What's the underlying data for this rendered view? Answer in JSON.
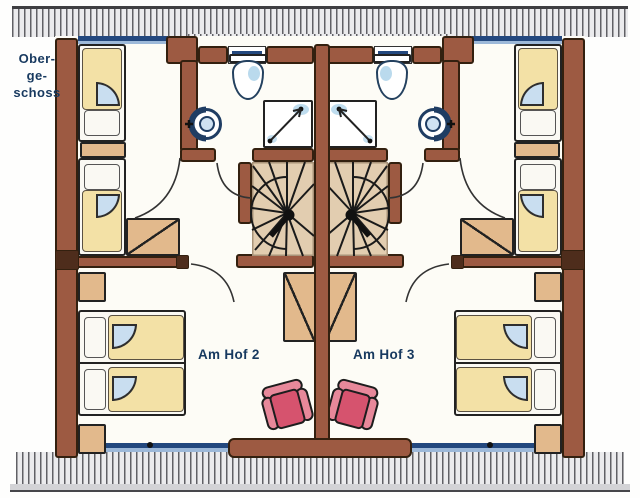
{
  "labels": {
    "floor_line1": "Ober-",
    "floor_line2": "ge-",
    "floor_line3": "schoss"
  },
  "units": [
    {
      "label": "Am Hof 2",
      "side": "left"
    },
    {
      "label": "Am Hof 3",
      "side": "right"
    }
  ],
  "symbols": [
    "spiral-staircase",
    "toilet",
    "shower",
    "washbasin",
    "single-bed",
    "double-bed",
    "wardrobe",
    "nightstand",
    "armchair",
    "window",
    "door-arc",
    "terrace-hatching"
  ],
  "colors": {
    "wall": "#9d5a42",
    "wall_dark": "#4e2d1c",
    "outline": "#33200f",
    "hatch_ink": "#606065",
    "hatch_bg": "#ebebed",
    "floor": "#fdfcf6",
    "navy": "#23487e",
    "window_blue": "#9db9d9",
    "blanket": "#f3e1a6",
    "pillow": "#faf9f3",
    "tan": "#e2b98c",
    "stair": "#e2cdb0",
    "fan": "#c9def0",
    "fixture_wash": "#aed3ea",
    "chair": "#e7889a",
    "chair_seat": "#d6536e",
    "label": "#17395f"
  }
}
